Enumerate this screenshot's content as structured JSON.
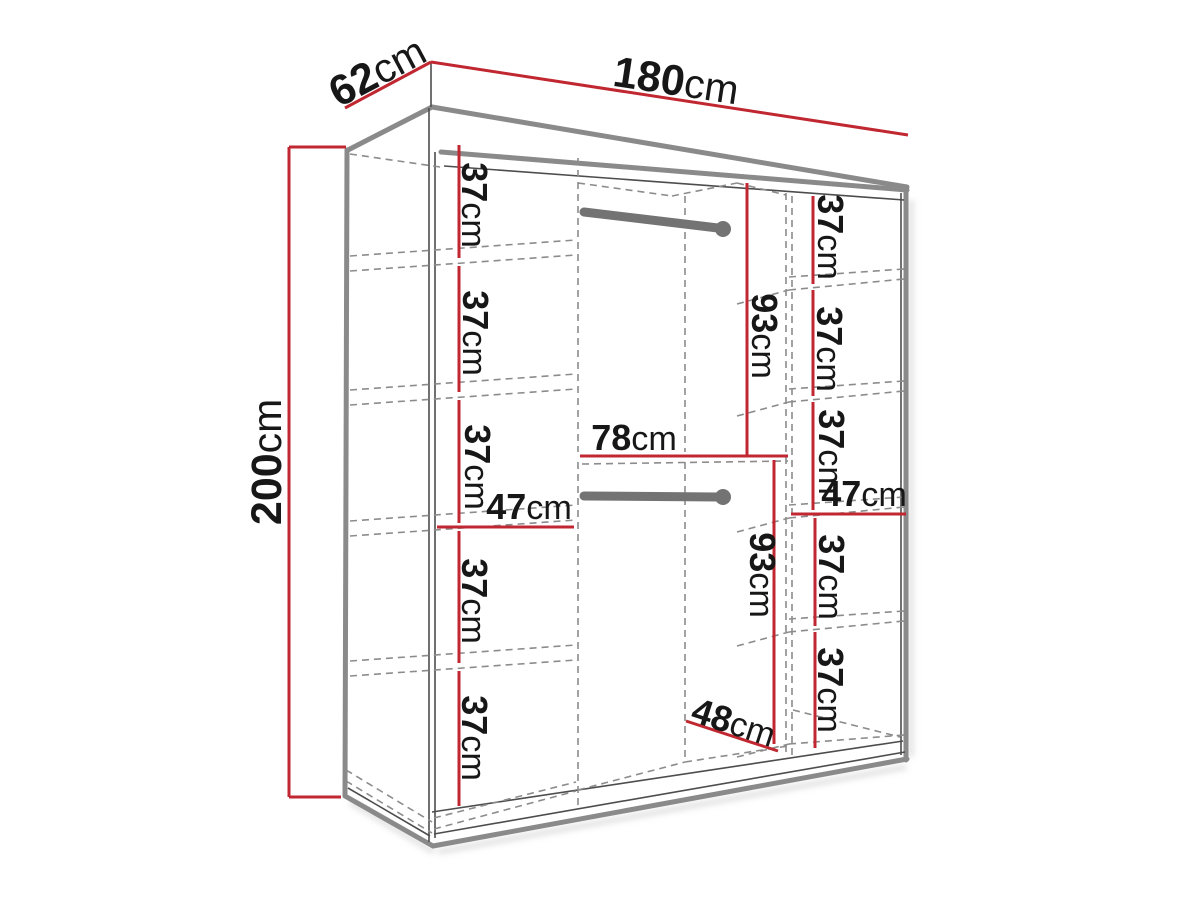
{
  "diagram": {
    "title": "Wardrobe dimension diagram",
    "unit": "cm",
    "overall": {
      "width_label": "180cm",
      "depth_label": "62cm",
      "height_label": "200cm"
    },
    "left_column": {
      "shelf_gaps": [
        "37cm",
        "37cm",
        "37cm",
        "37cm",
        "37cm"
      ],
      "width_label": "47cm"
    },
    "right_column": {
      "shelf_gaps": [
        "37cm",
        "37cm",
        "37cm",
        "37cm",
        "37cm"
      ],
      "width_label": "47cm"
    },
    "middle_section": {
      "upper_height_label": "93cm",
      "lower_height_label": "93cm",
      "width_label": "78cm",
      "depth_label": "48cm"
    },
    "colors": {
      "dimension_line": "#c02730",
      "structure_line": "#8a8a8a",
      "dashed_line": "#8c8c8c",
      "text": "#171717",
      "background": "#ffffff"
    }
  }
}
